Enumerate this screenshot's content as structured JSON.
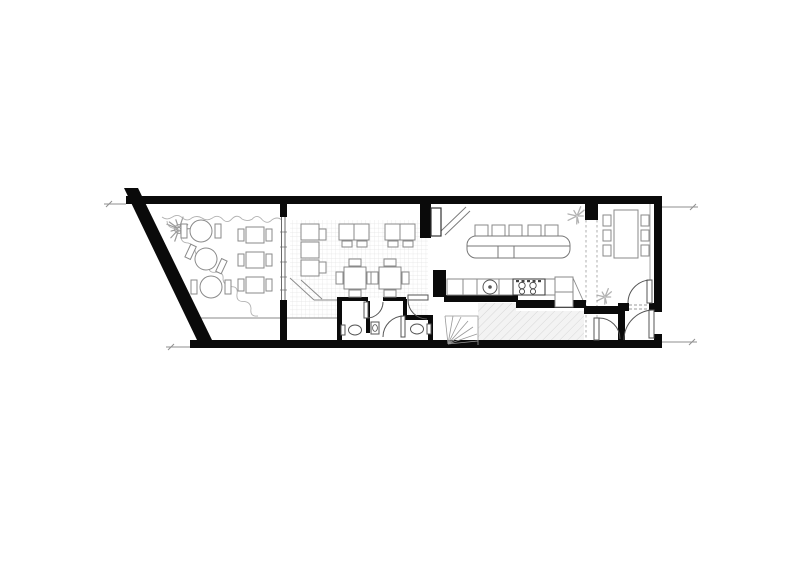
{
  "drawing": {
    "type": "architectural floor plan",
    "view": "top-down plan of a long narrow cafe/restaurant unit with terrace, dining room, restrooms, bar, kitchen and rear dining room",
    "background": "#ffffff",
    "colors": {
      "wall": "#0a0a0a",
      "furniture": "#8a8a8a",
      "fixture": "#555555",
      "tile": "#e4e4e4",
      "hatch": "#cfcfcf",
      "floor_shade": "#f3f3f3",
      "vegetation": "#b2b2b2",
      "dashes": "#9b9b9b",
      "dimension": "#8f8f8f"
    }
  },
  "terrace": {
    "round_tables": [
      {
        "cx": 201,
        "cy": 231,
        "rot": 0
      },
      {
        "cx": 206,
        "cy": 259,
        "rot": 25
      },
      {
        "cx": 211,
        "cy": 287,
        "rot": 0
      }
    ],
    "square_tables": [
      {
        "cx": 255,
        "cy": 235
      },
      {
        "cx": 255,
        "cy": 260
      },
      {
        "cx": 255,
        "cy": 285
      }
    ],
    "tree": {
      "cx": 179,
      "cy": 229,
      "r": 13
    }
  },
  "dining_room": {
    "banquette": {
      "x": 301,
      "y": 224,
      "w": 18,
      "seat_h": 18,
      "seats": 3
    },
    "side_tables": [
      {
        "x": 319,
        "y": 229
      },
      {
        "x": 319,
        "y": 262
      }
    ],
    "double_tables": [
      {
        "x": 339,
        "y": 224
      },
      {
        "x": 385,
        "y": 224
      }
    ],
    "four_top_tables": [
      {
        "cx": 355,
        "cy": 278
      },
      {
        "cx": 390,
        "cy": 278
      }
    ]
  },
  "bar": {
    "island": {
      "x": 467,
      "y": 236,
      "w": 103,
      "h": 22,
      "r": 9
    },
    "stools": {
      "xs": [
        475,
        492,
        509,
        528,
        545
      ],
      "y": 225,
      "w": 13,
      "h": 11
    }
  },
  "kitchen": {
    "sink": {
      "cx": 490,
      "cy": 287,
      "r": 7
    },
    "stove": {
      "x": 513,
      "y": 279,
      "w": 32,
      "h": 16
    }
  },
  "restrooms": {
    "toilets": [
      {
        "cx": 355,
        "cy": 330,
        "tank": "left"
      },
      {
        "cx": 417,
        "cy": 329,
        "tank": "right"
      }
    ],
    "hand_basin": {
      "x": 371,
      "y": 322,
      "w": 8,
      "h": 12
    }
  },
  "rear_dining": {
    "table": {
      "x": 614,
      "y": 210,
      "w": 24,
      "h": 48
    },
    "chair_rows_y": [
      215,
      230,
      245
    ],
    "chair_cols_x": [
      603,
      641
    ]
  },
  "plants": [
    {
      "cx": 577,
      "cy": 216,
      "r": 10
    },
    {
      "cx": 605,
      "cy": 297,
      "r": 9
    }
  ],
  "vine": {
    "top": {
      "x1": 162,
      "y1": 217,
      "x2": 282,
      "y2": 220,
      "segs": 12,
      "amp": 6
    },
    "side": {
      "x1": 167,
      "y1": 221,
      "x2": 258,
      "y2": 316,
      "segs": 13,
      "amp": 7
    }
  }
}
